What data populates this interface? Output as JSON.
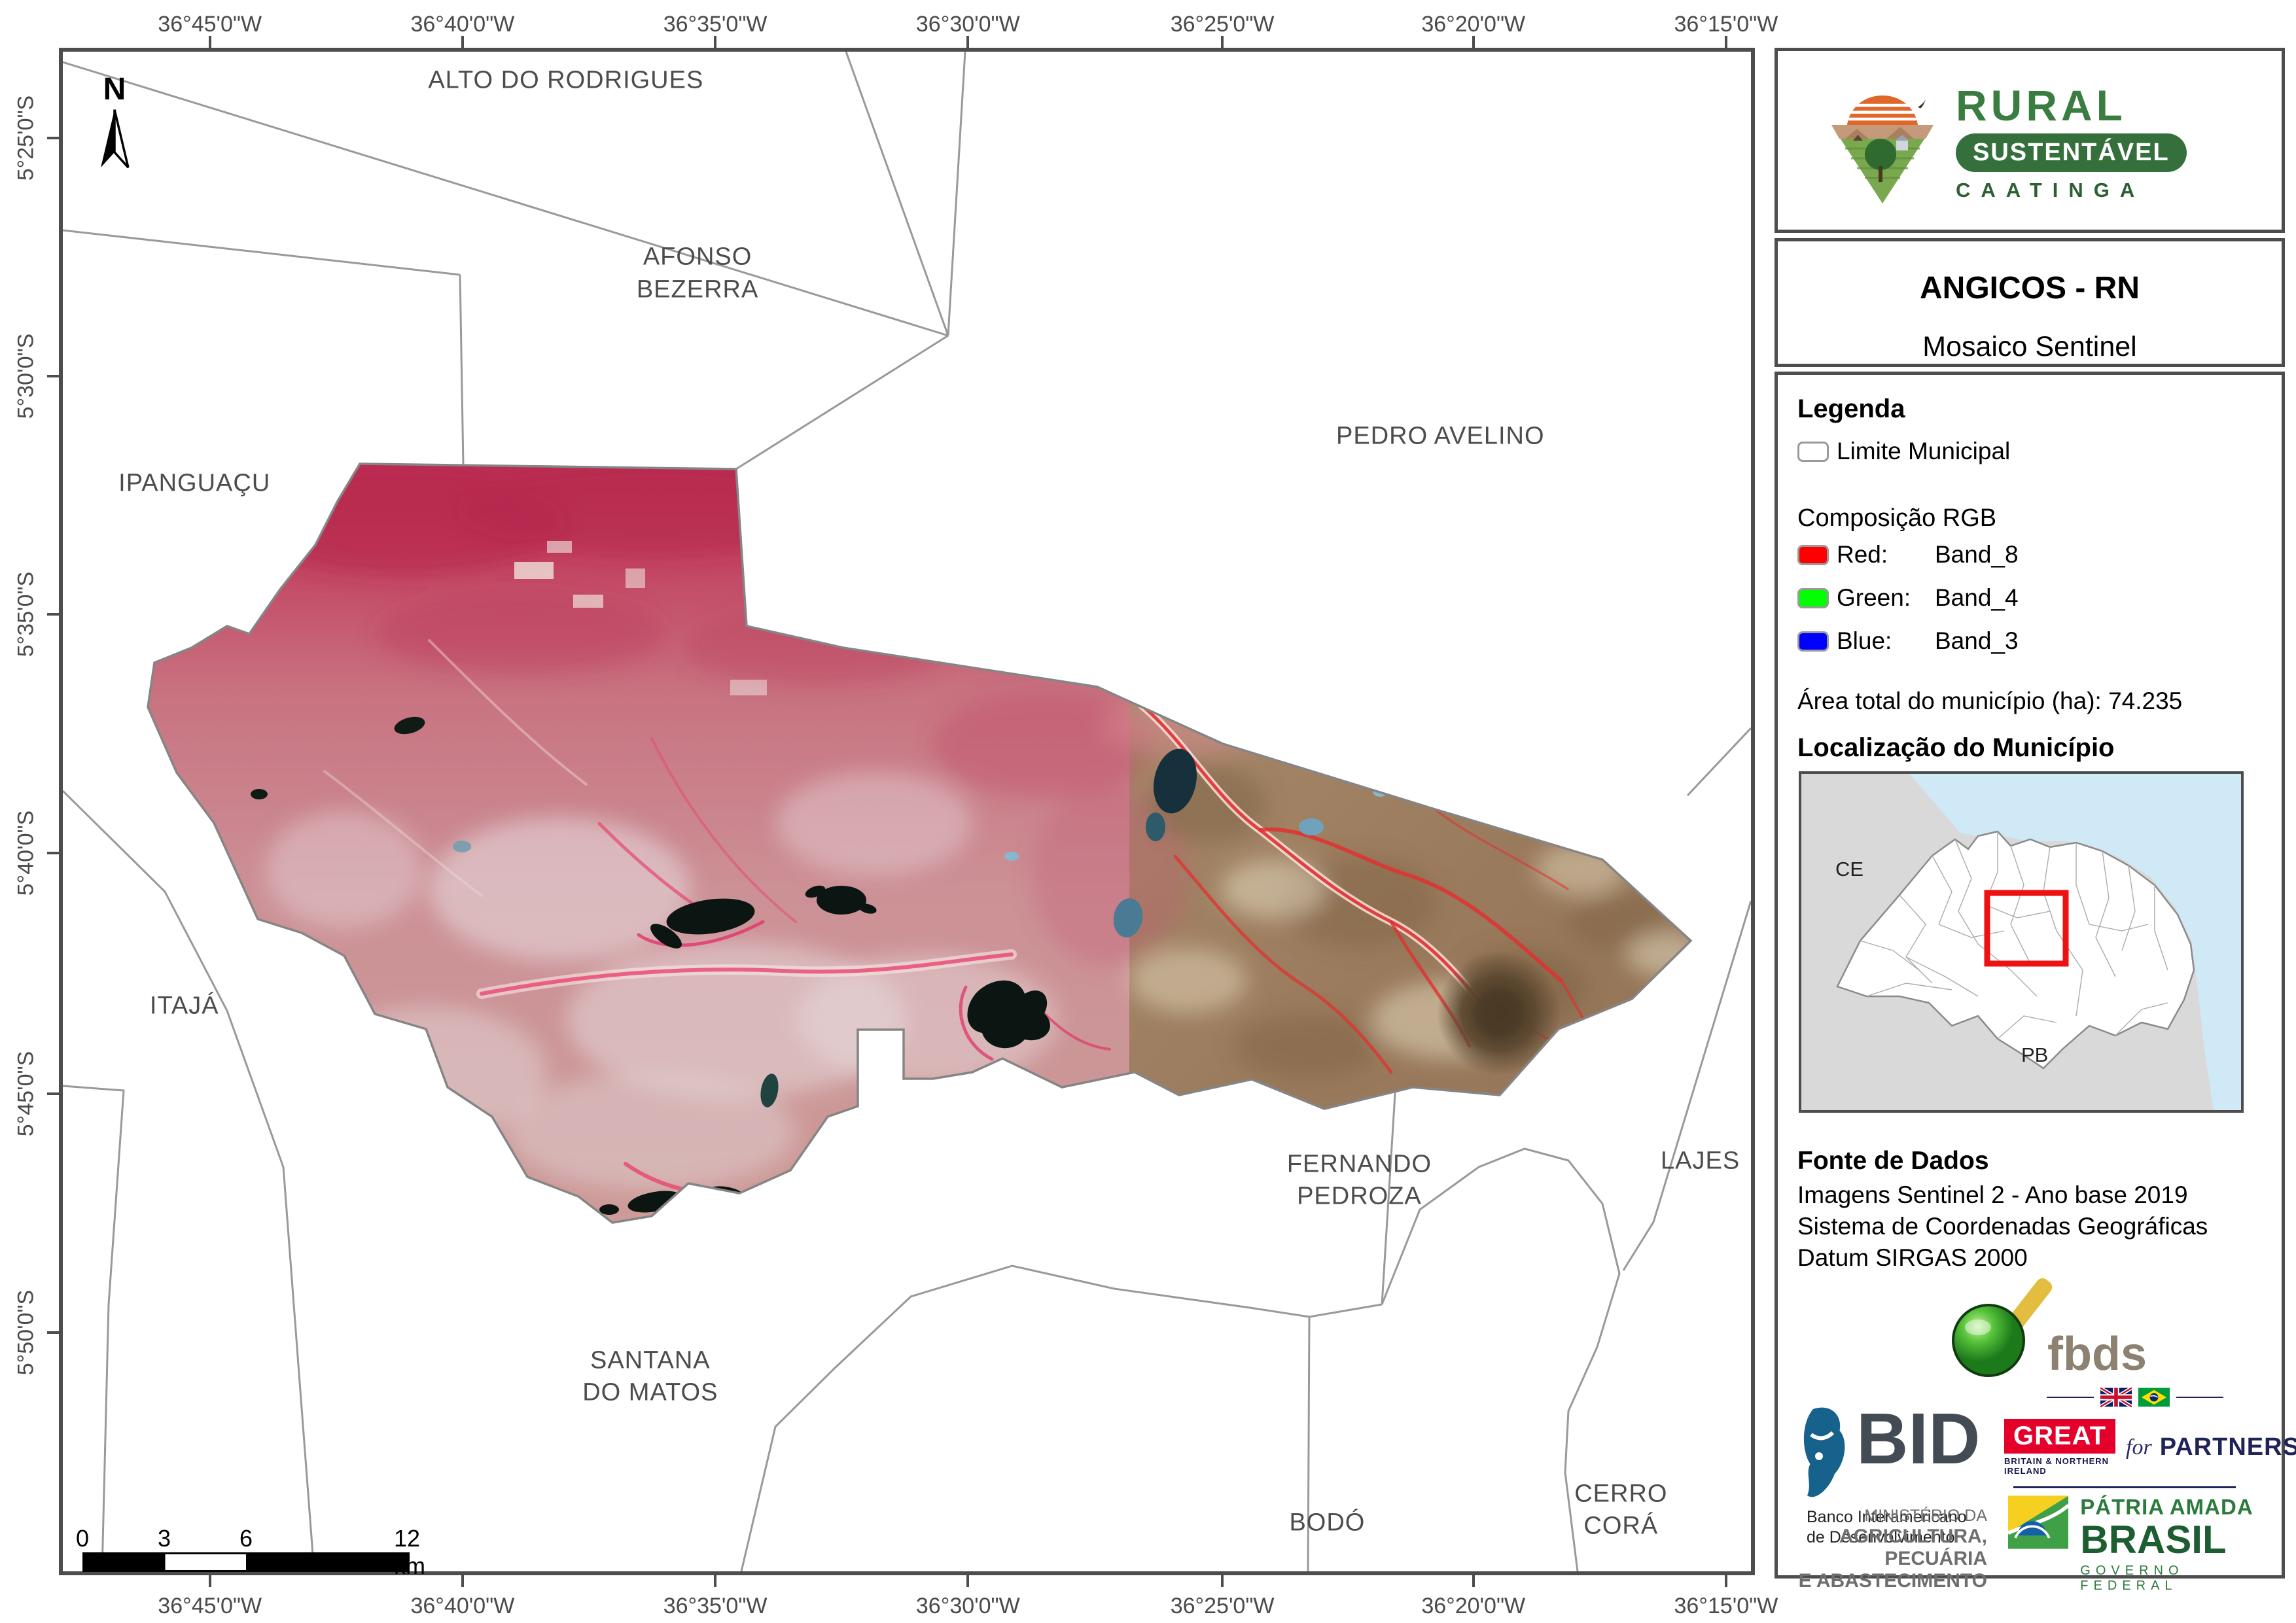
{
  "map": {
    "graticule": {
      "lon_labels": [
        "36°45'0\"W",
        "36°40'0\"W",
        "36°35'0\"W",
        "36°30'0\"W",
        "36°25'0\"W",
        "36°20'0\"W",
        "36°15'0\"W"
      ],
      "lat_labels": [
        "5°25'0\"S",
        "5°30'0\"S",
        "5°35'0\"S",
        "5°40'0\"S",
        "5°45'0\"S",
        "5°50'0\"S"
      ]
    },
    "north_label": "N",
    "places": [
      {
        "label": "ALTO DO RODRIGUES",
        "x": 29.8,
        "y": 1.9
      },
      {
        "label": "AFONSO\nBEZERRA",
        "x": 37.6,
        "y": 14.6
      },
      {
        "label": "PEDRO AVELINO",
        "x": 81.6,
        "y": 25.3
      },
      {
        "label": "IPANGUAÇU",
        "x": 7.8,
        "y": 28.4
      },
      {
        "label": "ITAJÁ",
        "x": 7.2,
        "y": 62.8
      },
      {
        "label": "FERNANDO\nPEDROZA",
        "x": 76.8,
        "y": 74.3
      },
      {
        "label": "LAJES",
        "x": 97.0,
        "y": 73.0
      },
      {
        "label": "SANTANA\nDO MATOS",
        "x": 34.8,
        "y": 87.2
      },
      {
        "label": "BODÓ",
        "x": 74.9,
        "y": 96.8
      },
      {
        "label": "CERRO CORÁ",
        "x": 92.3,
        "y": 96.0
      }
    ],
    "scalebar": {
      "labels": [
        "0",
        "3",
        "6",
        "12 km"
      ]
    }
  },
  "panel": {
    "logo": {
      "title": "RURAL",
      "subtitle": "SUSTENTÁVEL",
      "tagline": "CAATINGA"
    },
    "title": "ANGICOS - RN",
    "subtitle": "Mosaico Sentinel",
    "legend": {
      "heading": "Legenda",
      "limite_label": "Limite Municipal",
      "limite_color": "#ffffff",
      "rgb_heading": "Composição RGB",
      "rgb_items": [
        {
          "key": "Red:",
          "value": "Band_8",
          "color": "#ff0000"
        },
        {
          "key": "Green:",
          "value": "Band_4",
          "color": "#00ff00"
        },
        {
          "key": "Blue:",
          "value": "Band_3",
          "color": "#0000ff"
        }
      ],
      "area_label": "Área total do município (ha):",
      "area_value": "74.235"
    },
    "location": {
      "heading": "Localização do Município",
      "state_left": "CE",
      "state_bottom": "PB",
      "highlight_color": "#ee1111"
    },
    "fonte": {
      "heading": "Fonte de Dados",
      "lines": [
        "Imagens Sentinel 2 - Ano base 2019",
        "Sistema de Coordenadas Geográficas",
        "Datum SIRGAS 2000"
      ]
    },
    "credits": {
      "fbds": "fbds",
      "bid_acronym": "BID",
      "bid_sub": [
        "Banco Interamericano",
        "de Desenvolvimento"
      ],
      "great_box": "GREAT",
      "great_sub": "BRITAIN & NORTHERN IRELAND",
      "great_for": "for",
      "great_partnership": "PARTNERSHIP",
      "ministerio": [
        "MINISTÉRIO DA",
        "AGRICULTURA, PECUÁRIA",
        "E ABASTECIMENTO"
      ],
      "governo": [
        "PÁTRIA AMADA",
        "BRASIL",
        "GOVERNO FEDERAL"
      ]
    }
  }
}
